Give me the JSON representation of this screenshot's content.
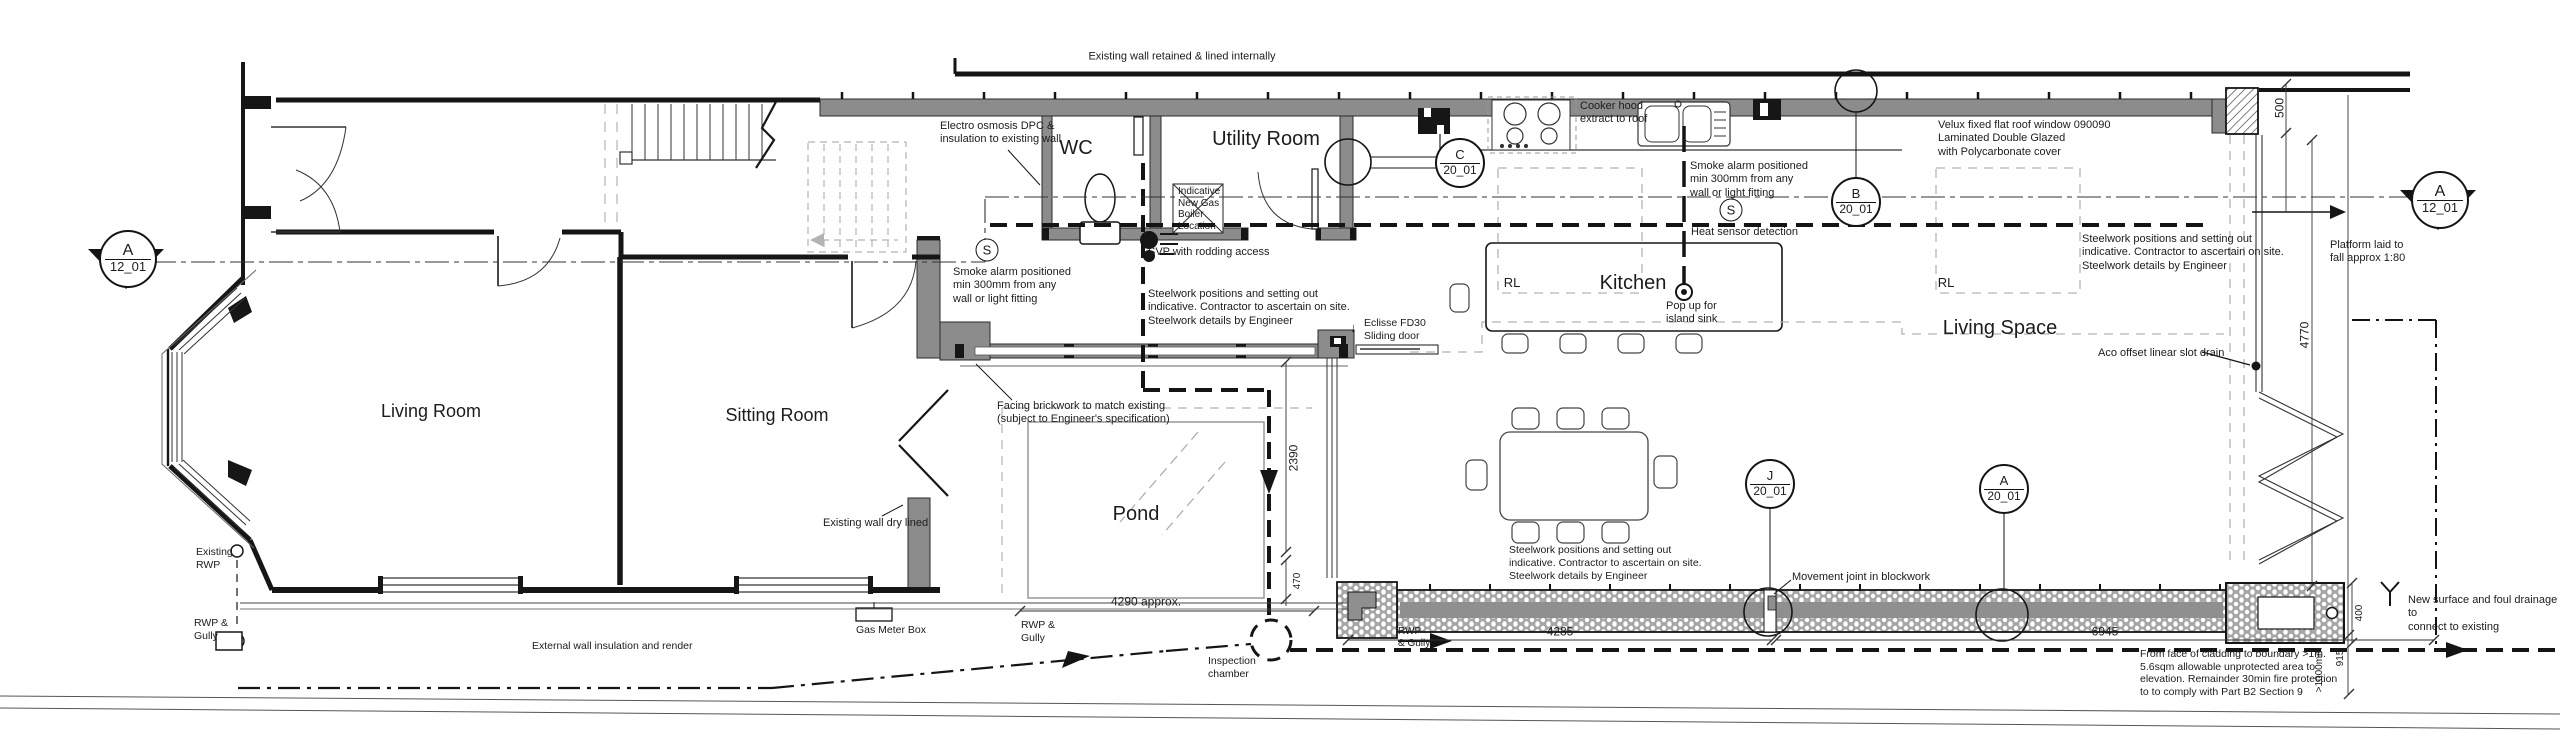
{
  "rooms": {
    "living_room": "Living Room",
    "sitting_room": "Sitting Room",
    "wc": "WC",
    "utility": "Utility Room",
    "kitchen": "Kitchen",
    "pond": "Pond",
    "living_space": "Living Space",
    "rooflight_1": "RL",
    "rooflight_2": "RL"
  },
  "notes": {
    "existing_wall": "Existing wall retained  & lined internally",
    "electro": "Electro osmosis DPC &\ninsulation to existing wall",
    "smoke_alarm_1": "Smoke alarm positioned\nmin 300mm from any\nwall or light fitting",
    "smoke_alarm_2": "Smoke alarm positioned\nmin 300mm from any\nwall or light fitting",
    "heat_sensor": "Heat sensor detection",
    "boiler": "Indicative\nNew Gas\nBoiler\nLocation",
    "svp": "SVP with rodding access",
    "eclisse": "Eclisse FD30\nSliding door",
    "steelwork_1": "Steelwork positions and setting out\nindicative. Contractor to ascertain on site.\nSteelwork details by Engineer",
    "steelwork_2": "Steelwork positions and setting out\nindicative. Contractor to ascertain on site.\nSteelwork details by Engineer",
    "steelwork_3": "Steelwork positions and setting out\nindicative. Contractor to ascertain on site.\nSteelwork details by Engineer",
    "cooker_hood": "Cooker hood\nextract to roof",
    "velux": "Velux fixed flat roof window 090090\nLaminated Double Glazed\nwith Polycarbonate cover",
    "popup_sink": "Pop up for\nisland sink",
    "facing_brickwork": "Facing brickwork to match existing\n(subject to Engineer's specification)",
    "dry_lined": "Existing wall dry lined",
    "gas_meter": "Gas Meter Box",
    "existing_rwp": "Existing\nRWP",
    "rwp_gully_1": "RWP &\nGully",
    "rwp_gully_2": "RWP &\nGully",
    "rwp_gully_3": "RWP\n& Gully",
    "inspection": "Inspection\nchamber",
    "platform": "Platform laid to\nfall approx 1:80",
    "aco": "Aco offset linear slot drain",
    "movement_joint": "Movement joint in blockwork",
    "external_render": "External wall insulation and render",
    "boundary_fire": "From face of cladding to boundary >1m.\n5.6sqm allowable unprotected area to\nelevation. Remainder 30min fire protection\nto to comply with Part B2 Section 9",
    "new_drainage": "New surface and foul drainage to\nconnect to existing"
  },
  "dimensions": {
    "d4290": "4290 approx.",
    "d4285": "4285",
    "d6945": "6945",
    "d2390": "2390",
    "d470": "470",
    "d500": "500",
    "d4770": "4770",
    "d915": "915",
    "d1000": ">1000mm",
    "d400": "400"
  },
  "markers": {
    "section_a_left": {
      "letter": "A",
      "sheet": "12_01"
    },
    "section_a_right": {
      "letter": "A",
      "sheet": "12_01"
    },
    "detail_c": {
      "letter": "C",
      "sheet": "20_01"
    },
    "detail_b": {
      "letter": "B",
      "sheet": "20_01"
    },
    "detail_j": {
      "letter": "J",
      "sheet": "20_01"
    },
    "detail_a": {
      "letter": "A",
      "sheet": "20_01"
    }
  },
  "symbols": {
    "smoke_1": "S",
    "smoke_2": "S",
    "sliding_arrow": "↓"
  },
  "colors": {
    "wall_black": "#161616",
    "existing_wall_grey": "#8c8c8c",
    "dashed_grey": "#b3b3b3",
    "text": "#1c1c1c"
  }
}
